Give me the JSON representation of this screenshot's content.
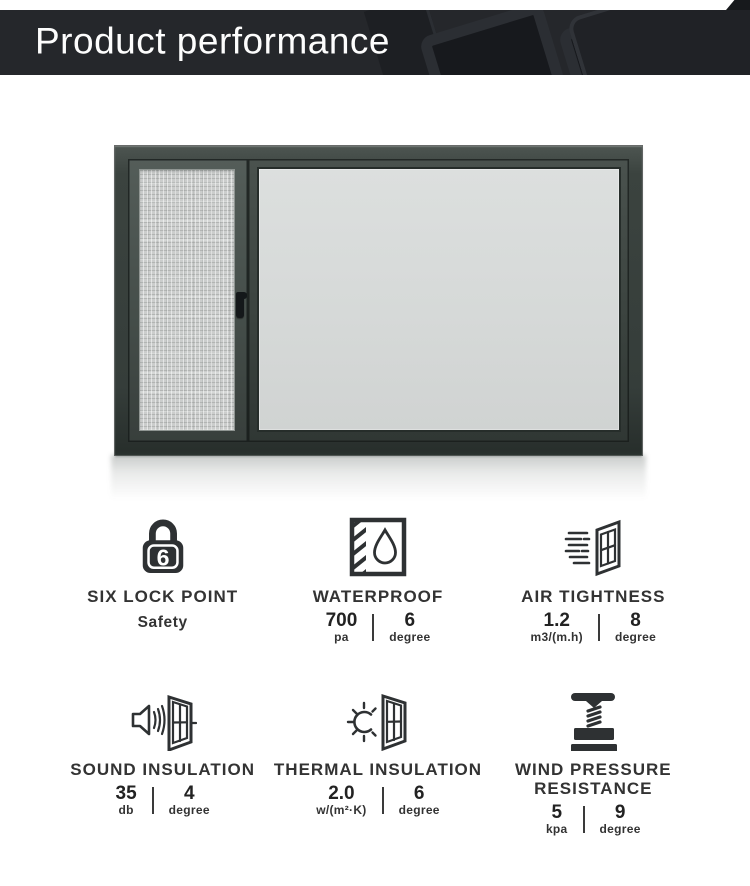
{
  "header": {
    "title": "Product performance",
    "bg_color": "#25272b",
    "text_color": "#fdfdfd"
  },
  "product_image": {
    "description_colors": {
      "frame": "#3a423e",
      "glass": "#d6d9d8",
      "flyscreen_mesh": "#cbcdcc"
    }
  },
  "features": [
    {
      "id": "six-lock-point",
      "icon": "lock-6-icon",
      "title": "SIX LOCK POINT",
      "subtitle": "Safety"
    },
    {
      "id": "waterproof",
      "icon": "waterproof-icon",
      "title": "WATERPROOF",
      "value1": "700",
      "unit1": "pa",
      "value2": "6",
      "unit2": "degree"
    },
    {
      "id": "air-tightness",
      "icon": "air-tightness-icon",
      "title": "AIR TIGHTNESS",
      "value1": "1.2",
      "unit1": "m3/(m.h)",
      "value2": "8",
      "unit2": "degree"
    },
    {
      "id": "sound-insulation",
      "icon": "sound-insulation-icon",
      "title": "SOUND INSULATION",
      "value1": "35",
      "unit1": "db",
      "value2": "4",
      "unit2": "degree"
    },
    {
      "id": "thermal-insulation",
      "icon": "thermal-insulation-icon",
      "title": "THERMAL INSULATION",
      "value1": "2.0",
      "unit1": "w/(m²·K)",
      "value2": "6",
      "unit2": "degree"
    },
    {
      "id": "wind-pressure-resistance",
      "icon": "wind-pressure-icon",
      "title": "WIND PRESSURE RESISTANCE",
      "value1": "5",
      "unit1": "kpa",
      "value2": "9",
      "unit2": "degree"
    }
  ],
  "icon_color": "#2e3133"
}
